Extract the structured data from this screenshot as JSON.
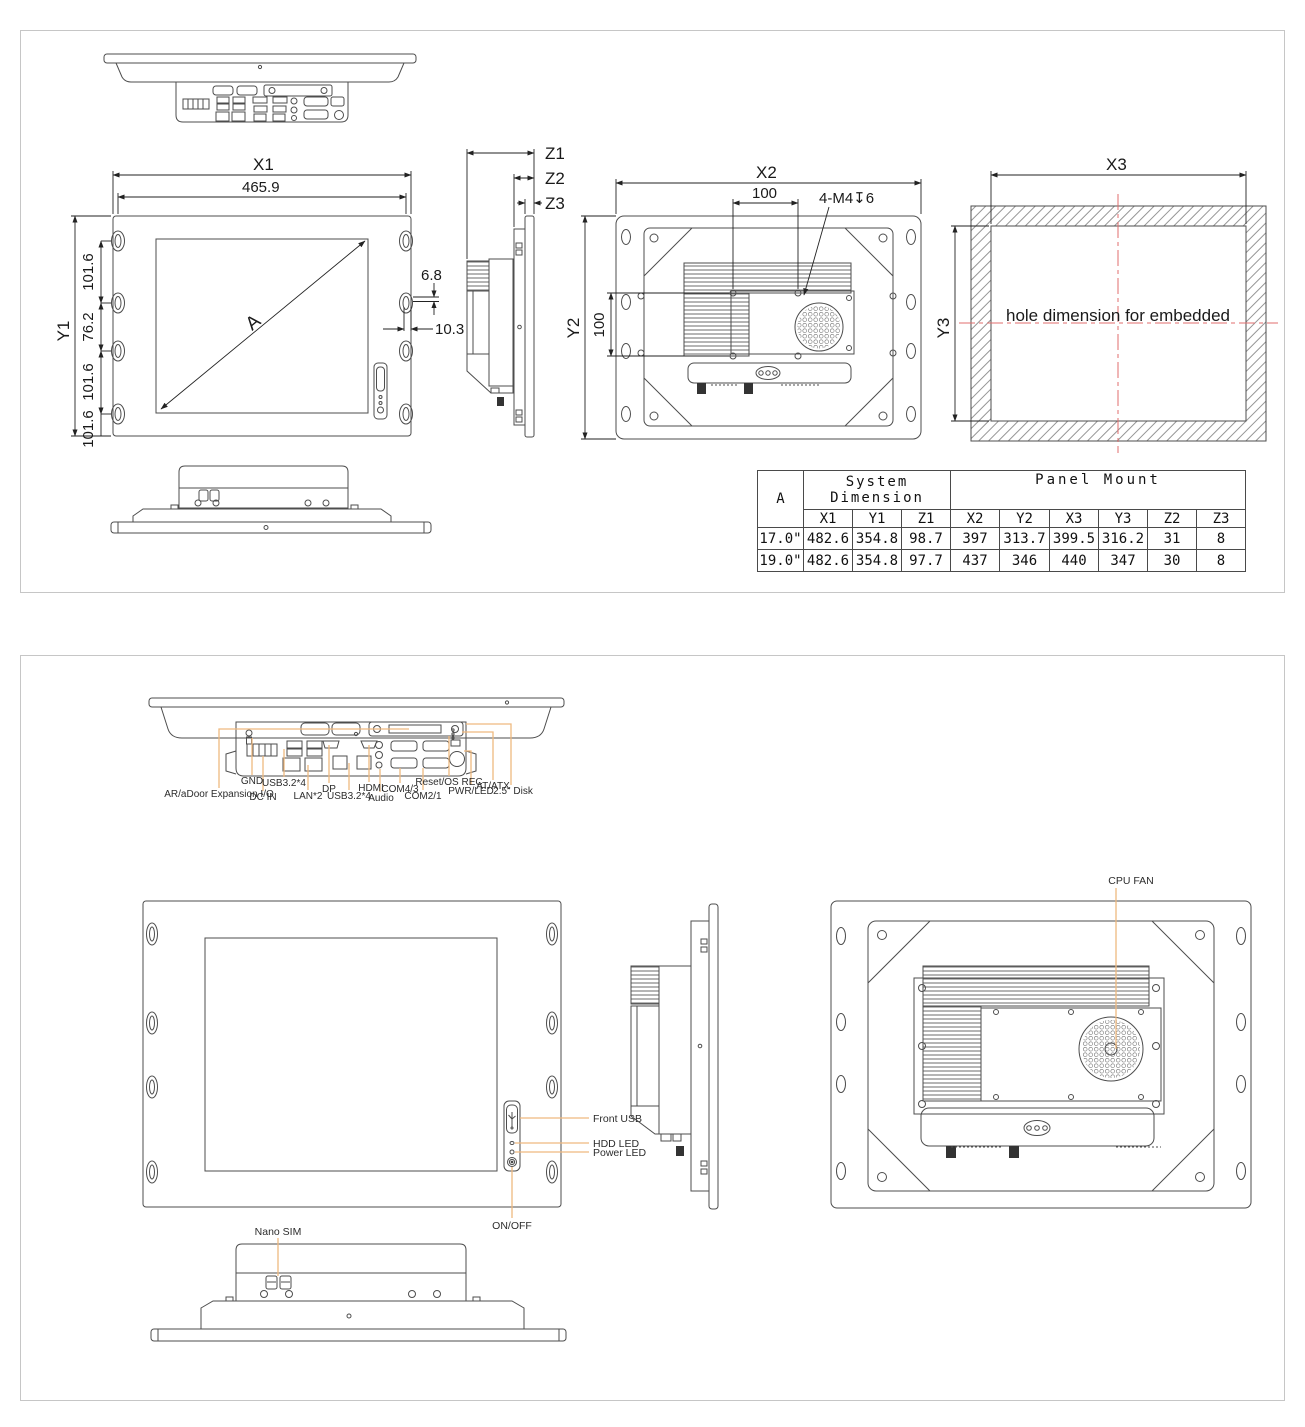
{
  "colors": {
    "line": "#4d4d4d",
    "dim": "#222222",
    "leader": "#efb97f",
    "centerline": "#e06c6c",
    "sheet_border": "#c6c6c6"
  },
  "sheet1": {
    "front": {
      "x1": "X1",
      "x1_val": "465.9",
      "y1": "Y1",
      "seg1": "101.6",
      "seg2": "76.2",
      "seg3": "101.6",
      "seg4": "101.6",
      "diag": "A",
      "ear_offset": "6.8",
      "ear_depth": "10.3"
    },
    "side": {
      "z1": "Z1",
      "z2": "Z2",
      "z3": "Z3"
    },
    "rear": {
      "x2": "X2",
      "vesa_h": "100",
      "vesa_v": "100",
      "y2": "Y2",
      "thread_note": "4-M4↧6"
    },
    "embedded": {
      "x3": "X3",
      "y3": "Y3",
      "note": "hole dimension for embedded"
    },
    "table": {
      "corner": "A",
      "group1_line1": "System",
      "group1_line2": "Dimension",
      "group2": "Panel Mount",
      "headers": [
        "X1",
        "Y1",
        "Z1",
        "X2",
        "Y2",
        "X3",
        "Y3",
        "Z2",
        "Z3"
      ],
      "rows": [
        {
          "label": "17.0\"",
          "values": [
            "482.6",
            "354.8",
            "98.7",
            "397",
            "313.7",
            "399.5",
            "316.2",
            "31",
            "8"
          ]
        },
        {
          "label": "19.0\"",
          "values": [
            "482.6",
            "354.8",
            "97.7",
            "437",
            "346",
            "440",
            "347",
            "30",
            "8"
          ]
        }
      ]
    }
  },
  "sheet2": {
    "io": {
      "gnd": "GND",
      "expansion": "AR/aDoor Expansion I/O",
      "dcin": "DC IN",
      "usb_a": "USB3.2*4",
      "lan": "LAN*2",
      "dp": "DP",
      "usb_b": "USB3.2*4",
      "hdmi": "HDMI",
      "audio": "Audio",
      "com43": "COM4/3",
      "com21": "COM2/1",
      "reset": "Reset/OS REC",
      "pwrled": "PWR/LED",
      "atatx": "AT/ATX",
      "disk": "2.5\" Disk"
    },
    "front": {
      "front_usb": "Front USB",
      "hdd_led": "HDD LED",
      "power_led": "Power LED",
      "on_off": "ON/OFF"
    },
    "rear": {
      "cpu_fan": "CPU FAN"
    },
    "bottom": {
      "nano_sim": "Nano SIM"
    }
  }
}
